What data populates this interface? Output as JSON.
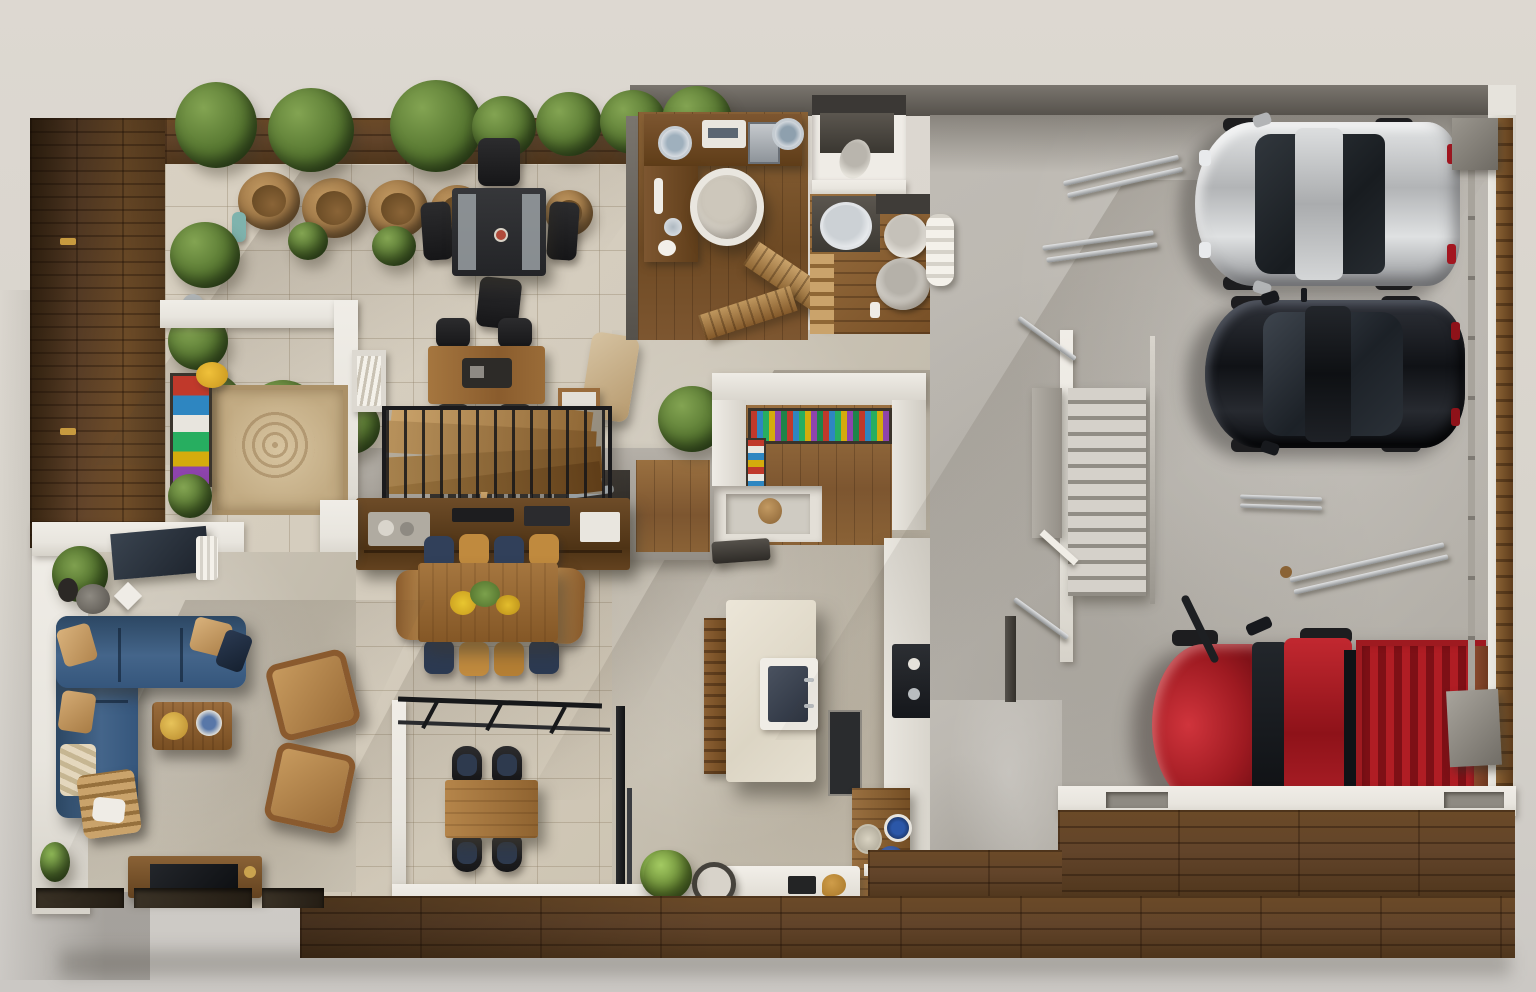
{
  "meta": {
    "title": "Top-down 3D architectural floor plan render of a house with terrace, living areas and three-car garage",
    "view": "top-down orthographic render",
    "visible_text": "none"
  },
  "palette": {
    "bg_top": "#ddd8d1",
    "bg_bottom": "#cbc8c4",
    "deck_mid": "#62442a",
    "patio_tile": "#d4ccbd",
    "concrete": "#b8b4ad",
    "wall_white": "#e8e5de",
    "wall_dark": "#4e4a44",
    "sofa_blue": "#3c5d80",
    "pillow_tan": "#c9a06a",
    "wood_furniture": "#9a6c3c",
    "car_silver": "#c9cbcd",
    "car_black": "#1b1d22",
    "truck_red": "#b01d24",
    "chair_navy": "#31405a",
    "chair_amber": "#c08a3e",
    "plant_green": "#567630",
    "bottle_colors": [
      "#c0392b",
      "#2e86c1",
      "#27ae60",
      "#d4ac0d",
      "#8e44ad"
    ]
  },
  "rooms": [
    {
      "name": "terrace-patio",
      "items": [
        "planter bushes",
        "terracotta pots",
        "black outdoor dining table with four chairs",
        "outdoor grill counter"
      ]
    },
    {
      "name": "entry",
      "items": [
        "ornate beige rug",
        "colorful art shelf",
        "yellow decor disk"
      ]
    },
    {
      "name": "stair-hall",
      "items": [
        "wood game table with four black chairs",
        "black metal stair railing",
        "walnut media console"
      ]
    },
    {
      "name": "dining-room",
      "items": [
        "walnut dining table",
        "yellow flower centerpiece",
        "navy and amber chairs"
      ]
    },
    {
      "name": "breakfast-nook",
      "items": [
        "glass wall with black frame",
        "square wood table",
        "four black chairs",
        "shrub"
      ]
    },
    {
      "name": "kitchen",
      "items": [
        "pantry counter with colorful bottle rack",
        "cream island with sink",
        "cooktop counter",
        "side table with blue bowls",
        "white bench",
        "round speaker",
        "plant"
      ]
    },
    {
      "name": "study",
      "items": [
        "L-shaped wooden desk",
        "white egg chair",
        "ceramic plates",
        "wooden ramp stairs"
      ]
    },
    {
      "name": "bathroom-upper",
      "items": [
        "dark vanity",
        "toilet"
      ]
    },
    {
      "name": "bathroom-lower",
      "items": [
        "vanity with oval sink",
        "toilet",
        "bidet",
        "wood steps"
      ]
    },
    {
      "name": "garage",
      "items": [
        "silver sedan",
        "black hatchback",
        "red pickup truck",
        "staircase",
        "metal rods on floor",
        "wall brackets",
        "rolled towel"
      ]
    },
    {
      "name": "living-room",
      "items": [
        "blue L-shaped sectional sofa",
        "tan pillows",
        "walnut coffee table with gold tray",
        "two cognac armchairs",
        "wood lounge chair",
        "TV console",
        "corner palm plant",
        "patterned window planters"
      ]
    },
    {
      "name": "decks",
      "items": [
        "left vertical plank deck",
        "bottom horizontal plank deck"
      ]
    }
  ],
  "vehicles": [
    {
      "name": "silver-sedan",
      "color": "#c9cbcd",
      "facing": "left"
    },
    {
      "name": "black-hatchback",
      "color": "#1b1d22",
      "facing": "left"
    },
    {
      "name": "red-pickup-truck",
      "color": "#b01d24",
      "facing": "left"
    }
  ]
}
